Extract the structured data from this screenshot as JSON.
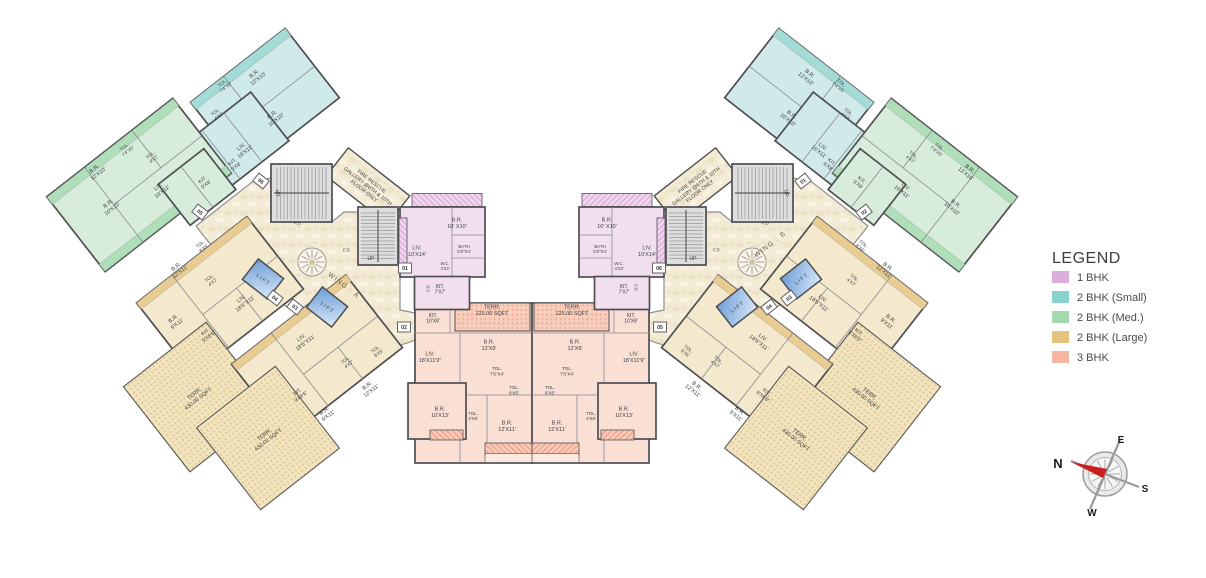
{
  "legend": {
    "title": "LEGEND",
    "items": [
      {
        "label": "1 BHK",
        "color": "#dcaedc"
      },
      {
        "label": "2 BHK (Small)",
        "color": "#8ad2cd"
      },
      {
        "label": "2 BHK (Med.)",
        "color": "#a2d9ae"
      },
      {
        "label": "2 BHK (Large)",
        "color": "#e4c380"
      },
      {
        "label": "3 BHK",
        "color": "#f5b5a0"
      }
    ]
  },
  "compass": {
    "n": "N",
    "e": "E",
    "s": "S",
    "w": "W"
  },
  "plan": {
    "mirror_sum": 1064,
    "wall_color": "#4f4f53",
    "inner_line_color": "#8a8a8e",
    "label_color": "#3e3e42",
    "fills": {
      "pink": "#f1dff0",
      "teal": "#cfeae8",
      "green": "#d7ecdb",
      "tan": "#f4e8cd",
      "salmon": "#fadfd4",
      "cream": "url(#marble)",
      "tanDots": "url(#dotsTan)",
      "salmonDots": "url(#dotsSalmon)",
      "pinkBand": "url(#hatchPink)",
      "salmonBand": "url(#hatchSalmon)",
      "tealBand": "#a3dbd7",
      "greenBand": "#aedfb8",
      "tanBand": "#e9cc92",
      "salmonLight": "#fbe9df",
      "lift": "url(#liftGrad)"
    },
    "courtyard_path": "M196,226 L252,182 L271,178 L271,222 L332,222 L344,212 L358,212 L358,265 L400,265 L400,310 L415,313 L415,340 Q388,352 362,342 Q340,333 322,324 Q300,315 284,305 Q262,293 248,281 Q220,258 196,226 Z",
    "medallion": {
      "x": 312,
      "y": 262,
      "r": 14
    },
    "stairs": [
      {
        "x": 271,
        "y": 164,
        "w": 61,
        "h": 58,
        "dir": "h"
      },
      {
        "x": 358,
        "y": 207,
        "w": 40,
        "h": 58,
        "dir": "v"
      }
    ],
    "lifts": [
      {
        "x": 263,
        "y": 279
      },
      {
        "x": 327,
        "y": 307
      }
    ],
    "wing_labels": [
      {
        "text": "WING : A",
        "x": 344,
        "y": 285,
        "rot": 38
      },
      {
        "text": "WING : B",
        "x": 770,
        "y": 244,
        "rot": -38
      }
    ],
    "units": [
      {
        "name": "unit-2bhk-small-upper",
        "fill": "teal",
        "cx": 265,
        "cy": 100,
        "w": 120,
        "h": 88,
        "rot": -38,
        "lines": [
          [
            -18,
            -44,
            -18,
            44
          ],
          [
            -18,
            4,
            60,
            4
          ]
        ],
        "bands": [
          [
            -60,
            -44,
            120,
            9,
            "tealBand"
          ]
        ]
      },
      {
        "name": "unit-2bhk-small-lower",
        "fill": "teal",
        "cx": 232,
        "cy": 146,
        "w": 96,
        "h": 62,
        "rot": -38,
        "lines": [
          [
            -14,
            -31,
            -14,
            31
          ],
          [
            14,
            -31,
            14,
            31
          ]
        ],
        "bands": [
          [
            -48,
            -31,
            9,
            62,
            "tealBand"
          ]
        ]
      },
      {
        "name": "unit-2bhk-med-main",
        "fill": "green",
        "cx": 139,
        "cy": 185,
        "w": 160,
        "h": 95,
        "rot": -38,
        "lines": [
          [
            -32,
            -47,
            -32,
            47
          ],
          [
            -32,
            0,
            80,
            0
          ],
          [
            28,
            -47,
            28,
            0
          ]
        ],
        "bands": [
          [
            -80,
            -47,
            160,
            9,
            "greenBand"
          ],
          [
            -80,
            38,
            160,
            9,
            "greenBand"
          ]
        ]
      },
      {
        "name": "unit-2bhk-med-ext",
        "fill": "green",
        "cx": 197,
        "cy": 187,
        "w": 58,
        "h": 52,
        "rot": -38,
        "lines": [
          [
            0,
            -26,
            0,
            26
          ]
        ],
        "bands": []
      },
      {
        "name": "unit-2bhk-large-04-main",
        "fill": "tan",
        "cx": 220,
        "cy": 296,
        "w": 140,
        "h": 92,
        "rot": -38,
        "lines": [
          [
            -25,
            -46,
            -25,
            46
          ],
          [
            -25,
            4,
            70,
            4
          ],
          [
            18,
            4,
            18,
            46
          ]
        ],
        "bands": [
          [
            -70,
            -46,
            140,
            8,
            "tanBand"
          ]
        ]
      },
      {
        "name": "unit-2bhk-large-04-terrace",
        "fill": "tanDots",
        "cx": 198,
        "cy": 397,
        "w": 105,
        "h": 108,
        "rot": -38,
        "sw": 1,
        "lines": [],
        "bands": []
      },
      {
        "name": "unit-2bhk-large-03-main",
        "fill": "tan",
        "cx": 317,
        "cy": 356,
        "w": 145,
        "h": 92,
        "rot": -38,
        "lines": [
          [
            -22,
            -46,
            -22,
            46
          ],
          [
            -22,
            6,
            72,
            6
          ],
          [
            22,
            6,
            22,
            46
          ]
        ],
        "bands": [
          [
            -72,
            -46,
            145,
            8,
            "tanBand"
          ]
        ]
      },
      {
        "name": "unit-2bhk-large-03-terrace",
        "fill": "tanDots",
        "cx": 268,
        "cy": 438,
        "w": 100,
        "h": 104,
        "rot": -38,
        "sw": 1,
        "lines": [],
        "bands": []
      },
      {
        "name": "fire-rescue-corridor",
        "fill": "cream",
        "cx": 368,
        "cy": 186,
        "w": 78,
        "h": 36,
        "rot": 38,
        "sw": 1.4,
        "lines": [],
        "bands": []
      },
      {
        "name": "unit-3bhk-main",
        "fill": "salmon",
        "cx": 473.5,
        "cy": 383,
        "w": 117,
        "h": 160,
        "rot": 0,
        "lines": [
          [
            -58.5,
            -50,
            58.5,
            -50
          ],
          [
            -13.5,
            -50,
            -13.5,
            12
          ],
          [
            -58.5,
            12,
            58.5,
            12
          ],
          [
            13.5,
            12,
            13.5,
            80
          ],
          [
            -13.5,
            12,
            -13.5,
            80
          ],
          [
            -23.5,
            -80,
            -23.5,
            -50
          ]
        ],
        "bands": []
      },
      {
        "name": "unit-3bhk-terrace",
        "fill": "salmonDots",
        "cx": 492.5,
        "cy": 317,
        "w": 75,
        "h": 28,
        "rot": 0,
        "sw": 1,
        "lines": [],
        "bands": []
      },
      {
        "name": "unit-3bhk-bedroom-wing",
        "fill": "salmon",
        "cx": 437,
        "cy": 411,
        "w": 58,
        "h": 56,
        "rot": 0,
        "lines": [],
        "bands": []
      },
      {
        "name": "unit-3bhk-balcony-strip",
        "fill": "salmonBand",
        "cx": 508.5,
        "cy": 449.5,
        "w": 47,
        "h": 13,
        "rot": 0,
        "sw": 0.8,
        "lines": [],
        "bands": []
      },
      {
        "name": "unit-3bhk-balcony-strip-2",
        "fill": "salmonBand",
        "cx": 446.5,
        "cy": 435,
        "w": 33,
        "h": 10,
        "rot": 0,
        "sw": 0.8,
        "lines": [],
        "bands": []
      },
      {
        "name": "unit-3bhk-apron",
        "fill": "salmonLight",
        "cx": 508.5,
        "cy": 458,
        "w": 47,
        "h": 9,
        "rot": 0,
        "sw": 0.6,
        "lines": [],
        "bands": []
      },
      {
        "name": "unit-1bhk-top-band",
        "fill": "pinkBand",
        "cx": 447,
        "cy": 200,
        "w": 70,
        "h": 13,
        "rot": 0,
        "sw": 0.8,
        "lines": [],
        "bands": []
      },
      {
        "name": "unit-1bhk-main",
        "fill": "pink",
        "cx": 442.5,
        "cy": 242,
        "w": 85,
        "h": 70,
        "rot": 0,
        "lines": [
          [
            9.5,
            -35,
            9.5,
            35
          ],
          [
            9.5,
            -7,
            42.5,
            -7
          ],
          [
            9.5,
            16,
            42.5,
            16
          ]
        ],
        "bands": []
      },
      {
        "name": "unit-1bhk-kitchen",
        "fill": "pink",
        "cx": 442,
        "cy": 293,
        "w": 55,
        "h": 33,
        "rot": 0,
        "lines": [],
        "bands": []
      },
      {
        "name": "unit-1bhk-side-band",
        "fill": "pinkBand",
        "cx": 403,
        "cy": 243,
        "w": 8,
        "h": 50,
        "rot": 0,
        "sw": 0.8,
        "lines": [],
        "bands": []
      }
    ],
    "badges": [
      {
        "x": 405,
        "y": 268,
        "rot": 0,
        "left": "01",
        "right": "06"
      },
      {
        "x": 404,
        "y": 327,
        "rot": 0,
        "left": "02",
        "right": "05"
      },
      {
        "x": 295,
        "y": 307,
        "rot": 38,
        "left": "03",
        "right": "04"
      },
      {
        "x": 275,
        "y": 298,
        "rot": 38,
        "left": "04",
        "right": "03"
      },
      {
        "x": 200,
        "y": 212,
        "rot": 38,
        "left": "05",
        "right": "02"
      },
      {
        "x": 261,
        "y": 181,
        "rot": 38,
        "left": "06",
        "right": "01"
      }
    ],
    "labels": [
      {
        "x": 256,
        "y": 76,
        "rot": -38,
        "size": 5.5,
        "text": "B.R.|12'X10'"
      },
      {
        "x": 224,
        "y": 85,
        "rot": -38,
        "size": 4.6,
        "text": "TOL.|7'4\"X5'"
      },
      {
        "x": 217,
        "y": 114,
        "rot": -38,
        "size": 4.6,
        "text": "TOL.|4'X7'"
      },
      {
        "x": 274,
        "y": 117,
        "rot": -38,
        "size": 5.5,
        "text": "B.R.|10'X10'"
      },
      {
        "x": 243,
        "y": 149,
        "rot": -38,
        "size": 5.5,
        "text": "LIV.|16'X11'"
      },
      {
        "x": 234,
        "y": 164,
        "rot": -38,
        "size": 5,
        "text": "KIT.|9'X8'"
      },
      {
        "x": 126,
        "y": 149,
        "rot": -38,
        "size": 4.6,
        "text": "TOL.|7'4\"X5'"
      },
      {
        "x": 152,
        "y": 157,
        "rot": -38,
        "size": 4.6,
        "text": "TOL.|4'X7'"
      },
      {
        "x": 96,
        "y": 171,
        "rot": -38,
        "size": 5.5,
        "text": "B.R.|12'X10'"
      },
      {
        "x": 160,
        "y": 189,
        "rot": -38,
        "size": 5.5,
        "text": "LIV.|16'X11'"
      },
      {
        "x": 204,
        "y": 182,
        "rot": -38,
        "size": 5,
        "text": "KIT.|9'X8'"
      },
      {
        "x": 110,
        "y": 206,
        "rot": -38,
        "size": 5.5,
        "text": "B.R.|10'X10'"
      },
      {
        "x": 202,
        "y": 246,
        "rot": -38,
        "size": 4.6,
        "text": "TOL.|8'X5'"
      },
      {
        "x": 178,
        "y": 269,
        "rot": -38,
        "size": 5.5,
        "text": "B.R.|12'X11'"
      },
      {
        "x": 211,
        "y": 280,
        "rot": -38,
        "size": 4.6,
        "text": "TOL.|4'X7'"
      },
      {
        "x": 175,
        "y": 321,
        "rot": -38,
        "size": 5.5,
        "text": "B.R.|9'X11'"
      },
      {
        "x": 207,
        "y": 334,
        "rot": -38,
        "size": 5,
        "text": "KIT.|9'X8'6\""
      },
      {
        "x": 243,
        "y": 301,
        "rot": -38,
        "size": 5.5,
        "text": "LIV.|18'6\"X11'"
      },
      {
        "x": 196,
        "y": 396,
        "rot": -38,
        "size": 5.5,
        "text": "TERR.|430.00 SQFT"
      },
      {
        "x": 303,
        "y": 340,
        "rot": -38,
        "size": 5.5,
        "text": "LIV.|18'6\"X11'"
      },
      {
        "x": 347,
        "y": 362,
        "rot": -38,
        "size": 4.6,
        "text": "TOL.|4'X7'"
      },
      {
        "x": 377,
        "y": 351,
        "rot": -38,
        "size": 4.6,
        "text": "TOL.|8'X5'"
      },
      {
        "x": 369,
        "y": 388,
        "rot": -38,
        "size": 5.5,
        "text": "B.R.|12'X11'"
      },
      {
        "x": 299,
        "y": 394,
        "rot": -38,
        "size": 5,
        "text": "KIT.|9'X8'6\""
      },
      {
        "x": 326,
        "y": 413,
        "rot": -38,
        "size": 5.5,
        "text": "B.R.|9'X11'"
      },
      {
        "x": 266,
        "y": 437,
        "rot": -38,
        "size": 5.5,
        "text": "TERR.|430.00 SQFT"
      },
      {
        "x": 433,
        "y": 318,
        "rot": 0,
        "size": 5,
        "text": "KIT.|10'X8'"
      },
      {
        "x": 492,
        "y": 310,
        "rot": 0,
        "size": 5.5,
        "text": "TERR.|125.00 SQFT"
      },
      {
        "x": 489,
        "y": 345,
        "rot": 0,
        "size": 5.5,
        "text": "B.R.|12'X9'"
      },
      {
        "x": 430,
        "y": 357,
        "rot": 0,
        "size": 5.5,
        "text": "LIV.|18'X11'9\""
      },
      {
        "x": 497,
        "y": 371,
        "rot": 0,
        "size": 4.6,
        "text": "TOL.|7'6\"X4'"
      },
      {
        "x": 514,
        "y": 390,
        "rot": 0,
        "size": 4.6,
        "text": "TOL.|8'X5'"
      },
      {
        "x": 440,
        "y": 412,
        "rot": 0,
        "size": 5.5,
        "text": "B.R.|10'X13'"
      },
      {
        "x": 473,
        "y": 416,
        "rot": 0,
        "size": 4.4,
        "text": "TOL.|4'X8'"
      },
      {
        "x": 507,
        "y": 426,
        "rot": 0,
        "size": 5.5,
        "text": "B.R.|12'X11'"
      },
      {
        "x": 457,
        "y": 223,
        "rot": 0,
        "size": 5.5,
        "text": "B.R.|10' X10'"
      },
      {
        "x": 417,
        "y": 251,
        "rot": 0,
        "size": 5.5,
        "text": "LIV.|10'X14'"
      },
      {
        "x": 464,
        "y": 249,
        "rot": 0,
        "size": 4.4,
        "text": "BATH|5'3\"X4'"
      },
      {
        "x": 445,
        "y": 266,
        "rot": 0,
        "size": 4.2,
        "text": "W.C.|4'X3'"
      },
      {
        "x": 440,
        "y": 289,
        "rot": 0,
        "size": 5,
        "text": "KIT.|7'X7'"
      },
      {
        "x": 428,
        "y": 288,
        "rot": -90,
        "size": 4.2,
        "text": "F.D."
      },
      {
        "x": 278,
        "y": 193,
        "rot": -90,
        "size": 5,
        "text": "UP"
      },
      {
        "x": 371,
        "y": 258,
        "rot": 0,
        "size": 5,
        "text": "UP"
      },
      {
        "x": 298,
        "y": 223,
        "rot": 0,
        "size": 4.4,
        "text": "F.D."
      },
      {
        "x": 347,
        "y": 250,
        "rot": 0,
        "size": 4.4,
        "text": "F.D."
      },
      {
        "x": 368,
        "y": 186,
        "rot": 38,
        "size": 5.2,
        "text": "FIRE RESCUE|GALLERY @6TH & 10TH|FLOOR ONLY"
      },
      {
        "x": 263,
        "y": 279,
        "rot": 38,
        "size": 5.2,
        "text": "L I F T"
      },
      {
        "x": 327,
        "y": 307,
        "rot": 38,
        "size": 5.2,
        "text": "L I F T"
      }
    ]
  }
}
